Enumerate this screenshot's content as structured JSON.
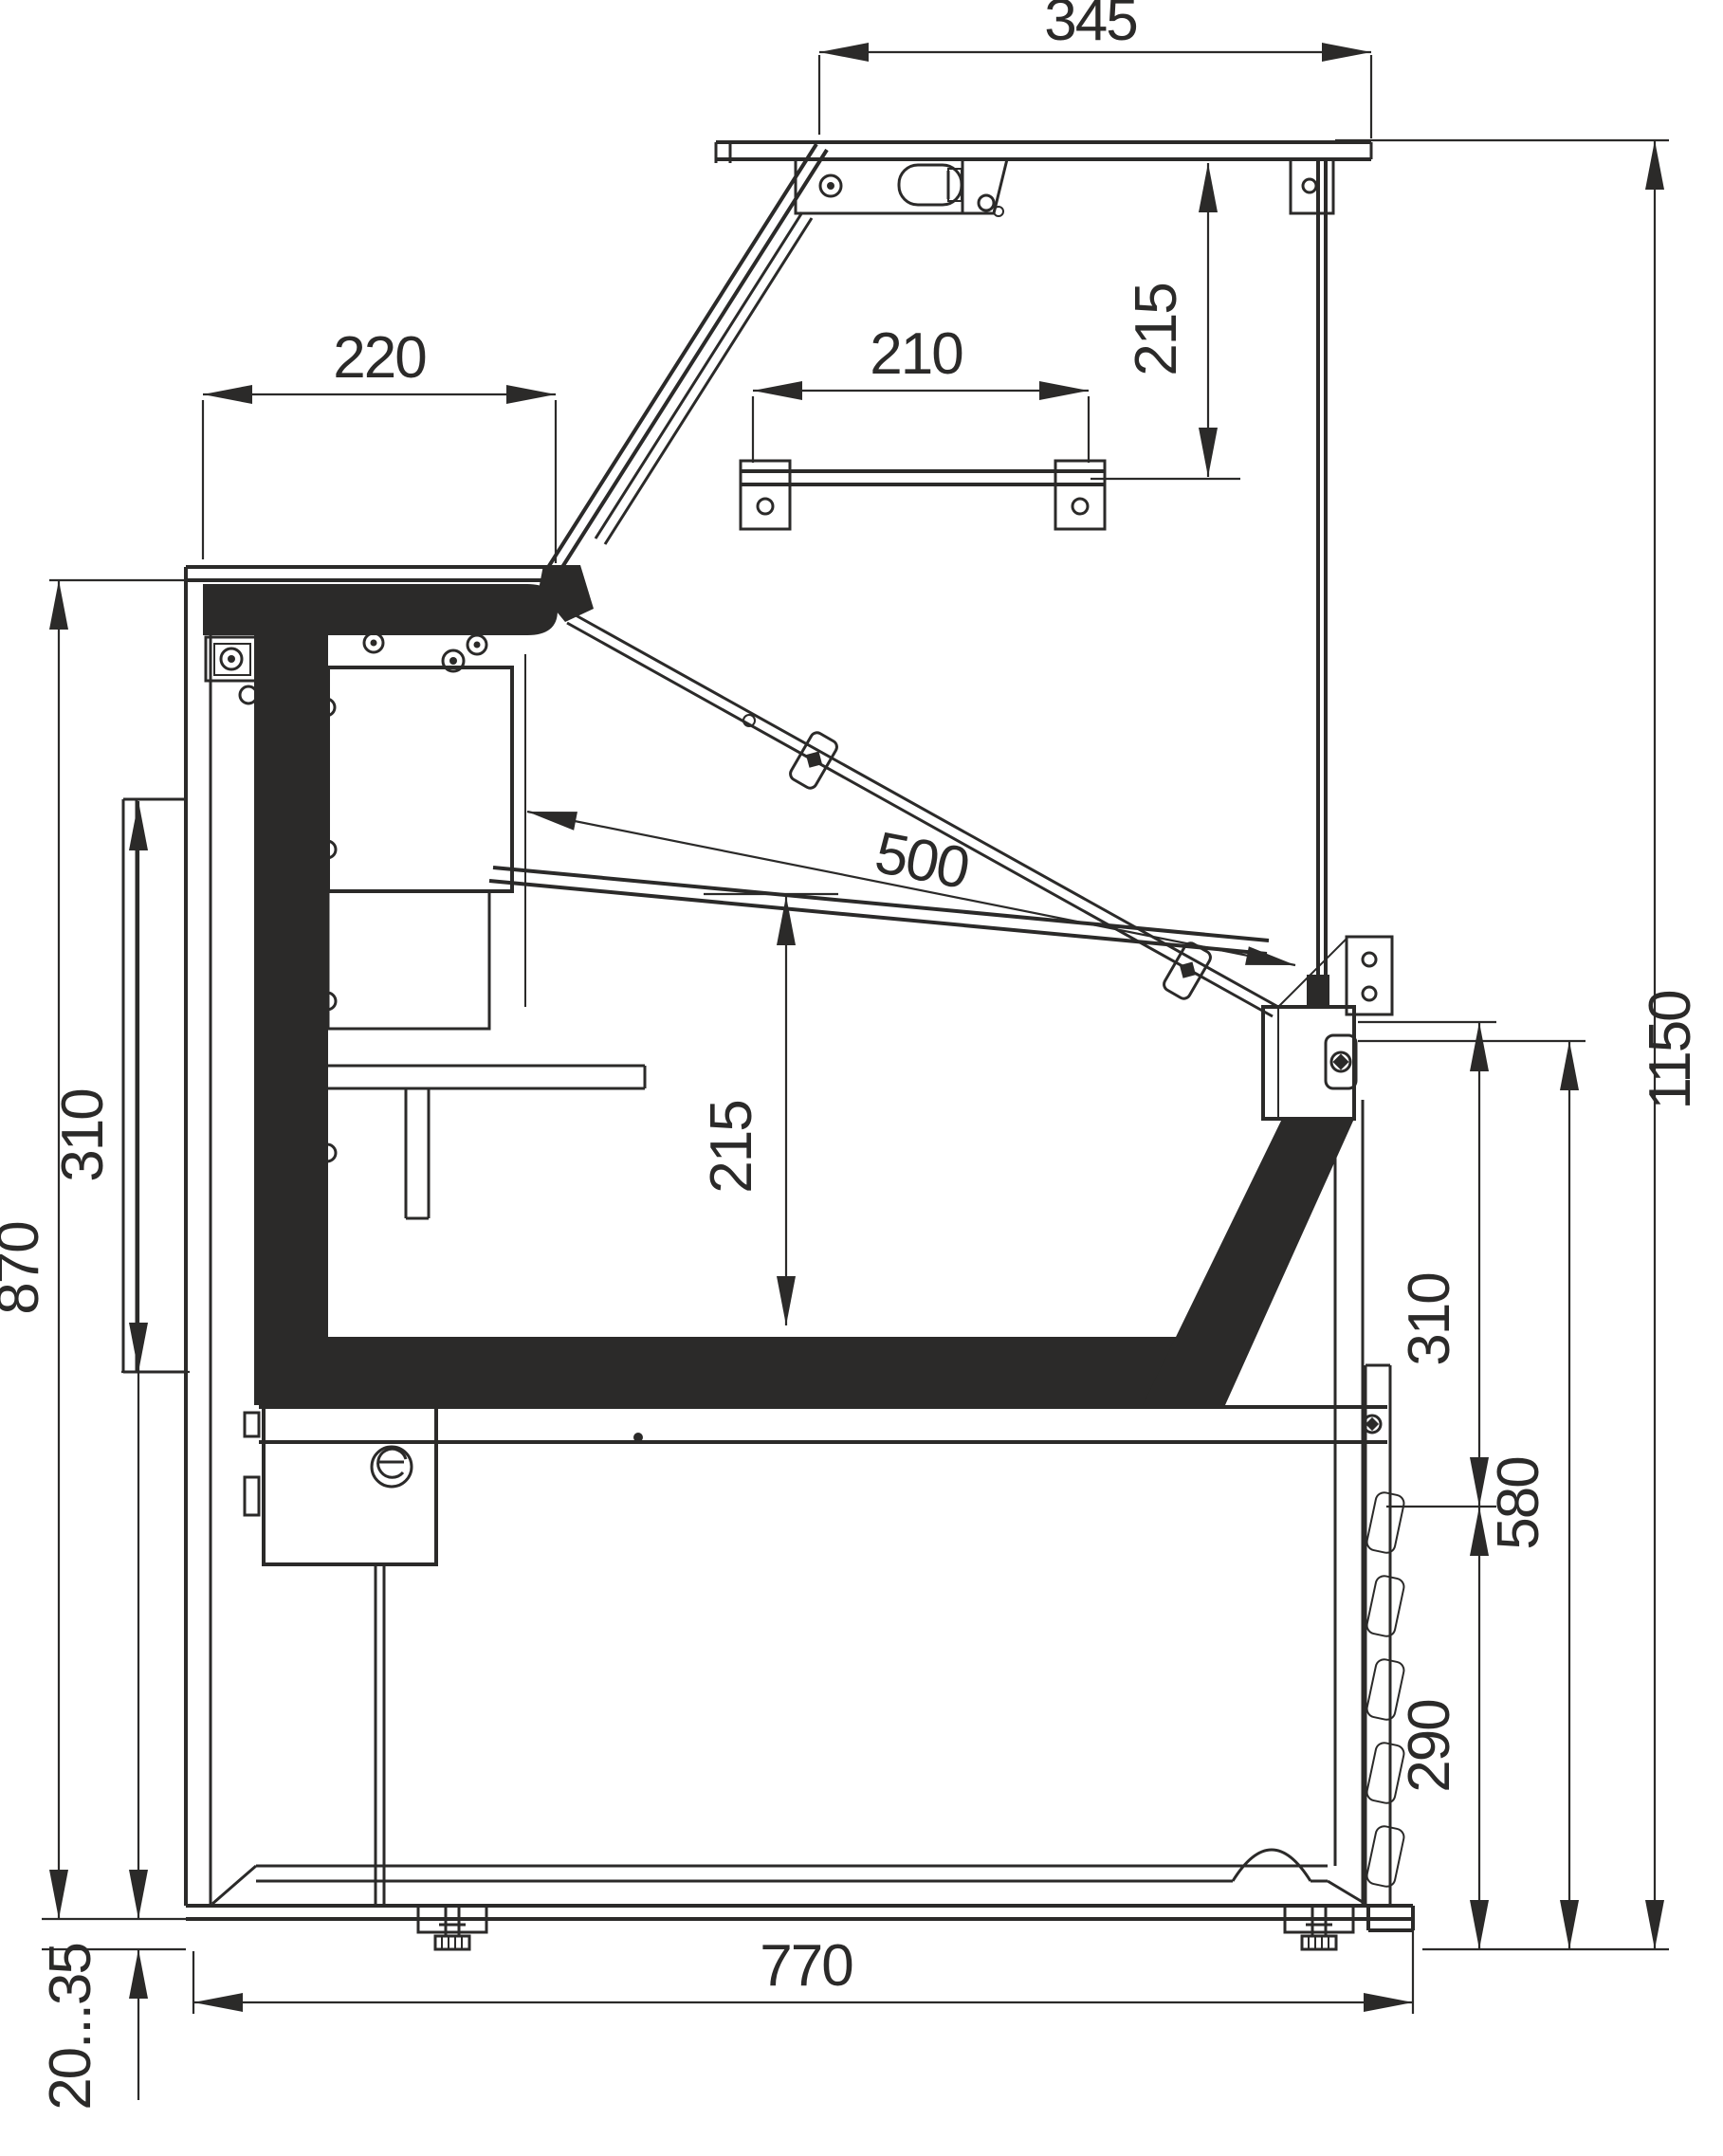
{
  "drawing": {
    "kind": "technical-cross-section",
    "subject": "refrigerated serve-over display counter, side section view",
    "line_color": "#2b2a29",
    "background_color": "#ffffff",
    "units_note": "",
    "dimensions": {
      "top_panel_width": "345",
      "canopy_inner_height": "215",
      "counter_top_depth": "220",
      "top_shelf_width": "210",
      "deck_usable_depth": "500",
      "well_inner_height": "215",
      "left_bumper_height": "310",
      "counter_height": "870",
      "overall_height": "1150",
      "front_glass_lower_height": "310",
      "base_section_height": "580",
      "louver_panel_height": "290",
      "base_width": "770",
      "foot_adjust_range": "20...35"
    }
  }
}
